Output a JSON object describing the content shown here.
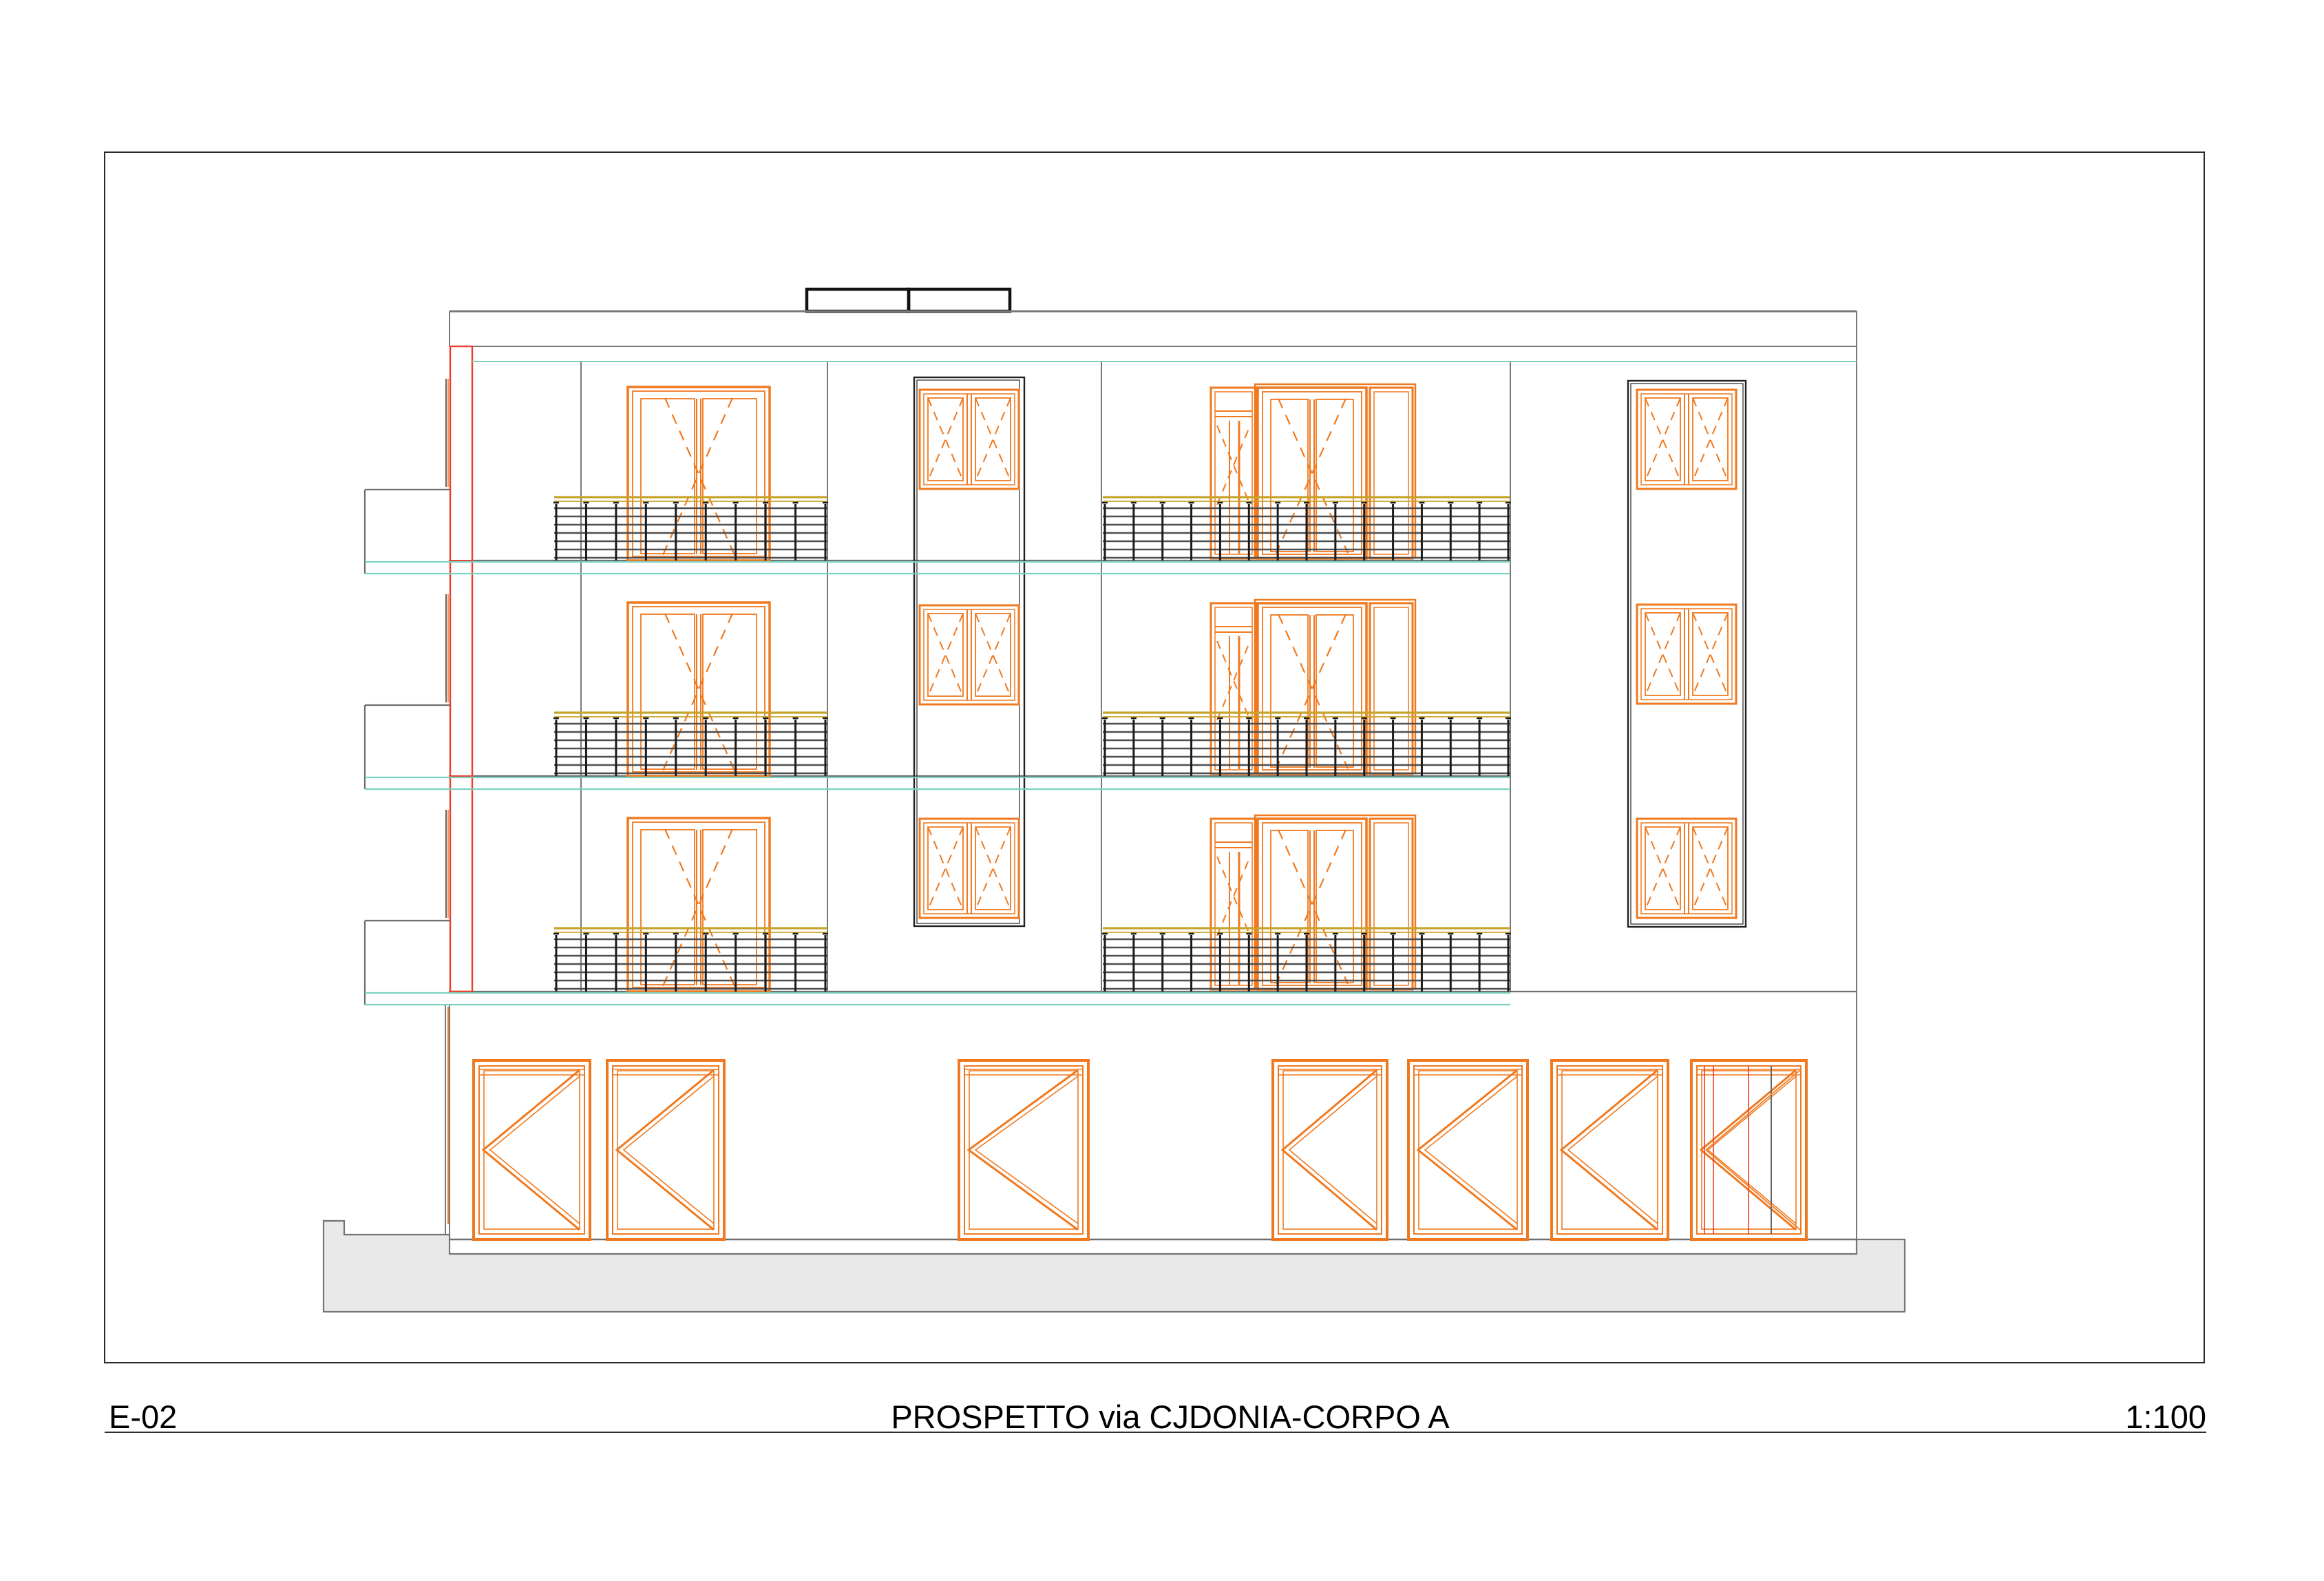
{
  "title_block": {
    "drawing_number": "E-02",
    "title": "PROSPETTO via CJDONIA-CORPO A",
    "scale": "1:100"
  },
  "drawing": {
    "floors": 3,
    "ground_floor_doors": 7,
    "stairwell_windows": 3,
    "side_window_columns": 2,
    "balcony_railings": 6
  },
  "colors": {
    "frame_orange": "#F0791F",
    "accent_red": "#EF3B2D",
    "slab_teal": "#7ED1C1",
    "rail_yellow": "#C7A42B",
    "line_gray": "#787878",
    "slab_gray": "#6E6E6E",
    "rail_gray": "#4F4F4F",
    "post_black": "#1C1C1C",
    "column_dark": "#222222",
    "sidewalk_fill": "#E9E9EA",
    "sidewalk_edge": "#747474",
    "frame_border": "#2A2A2A",
    "text": "#000000"
  }
}
